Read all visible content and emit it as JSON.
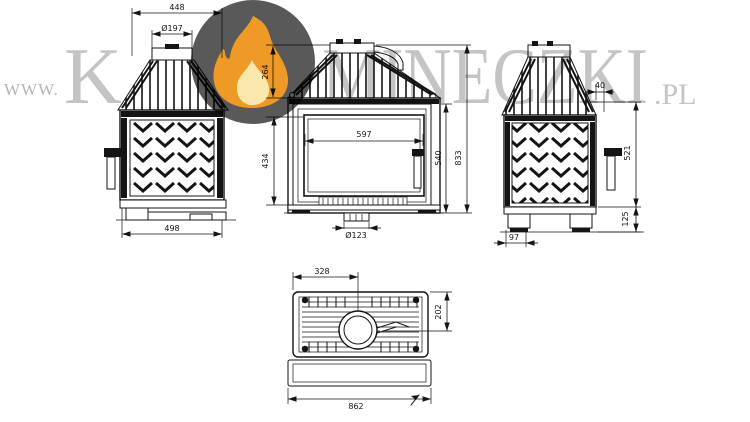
{
  "watermark": {
    "prefix": "WWW.",
    "big_k": "K",
    "big_rest": "MINECZKI",
    "suffix": ".PL",
    "prefix_color": "#b5b5b5",
    "text_color": "#c4c4c4",
    "logo": {
      "icon": "flame-icon",
      "circle_color": "#595959",
      "flame_outer": "#ef9a27",
      "flame_inner": "#f9e7ad"
    }
  },
  "drawing": {
    "line_color": "#141414",
    "background": "#ffffff",
    "views": {
      "side_left": {
        "title": "left side view",
        "dims": {
          "top_width": "448",
          "flue_diameter": "Ø197",
          "depth": "498"
        }
      },
      "front": {
        "title": "front view",
        "dims": {
          "hood_height": "264",
          "door_height": "434",
          "glass_width": "597",
          "body_height": "540",
          "total_height": "833",
          "air_inlet_diameter": "Ø123"
        }
      },
      "side_right": {
        "title": "right side view",
        "dims": {
          "collar_offset": "40",
          "rear_height": "521",
          "base_height": "125",
          "leg_width": "97"
        }
      },
      "bottom": {
        "title": "bottom view",
        "dims": {
          "flue_offset_x": "328",
          "flue_offset_y": "202",
          "total_width": "862"
        }
      }
    }
  }
}
